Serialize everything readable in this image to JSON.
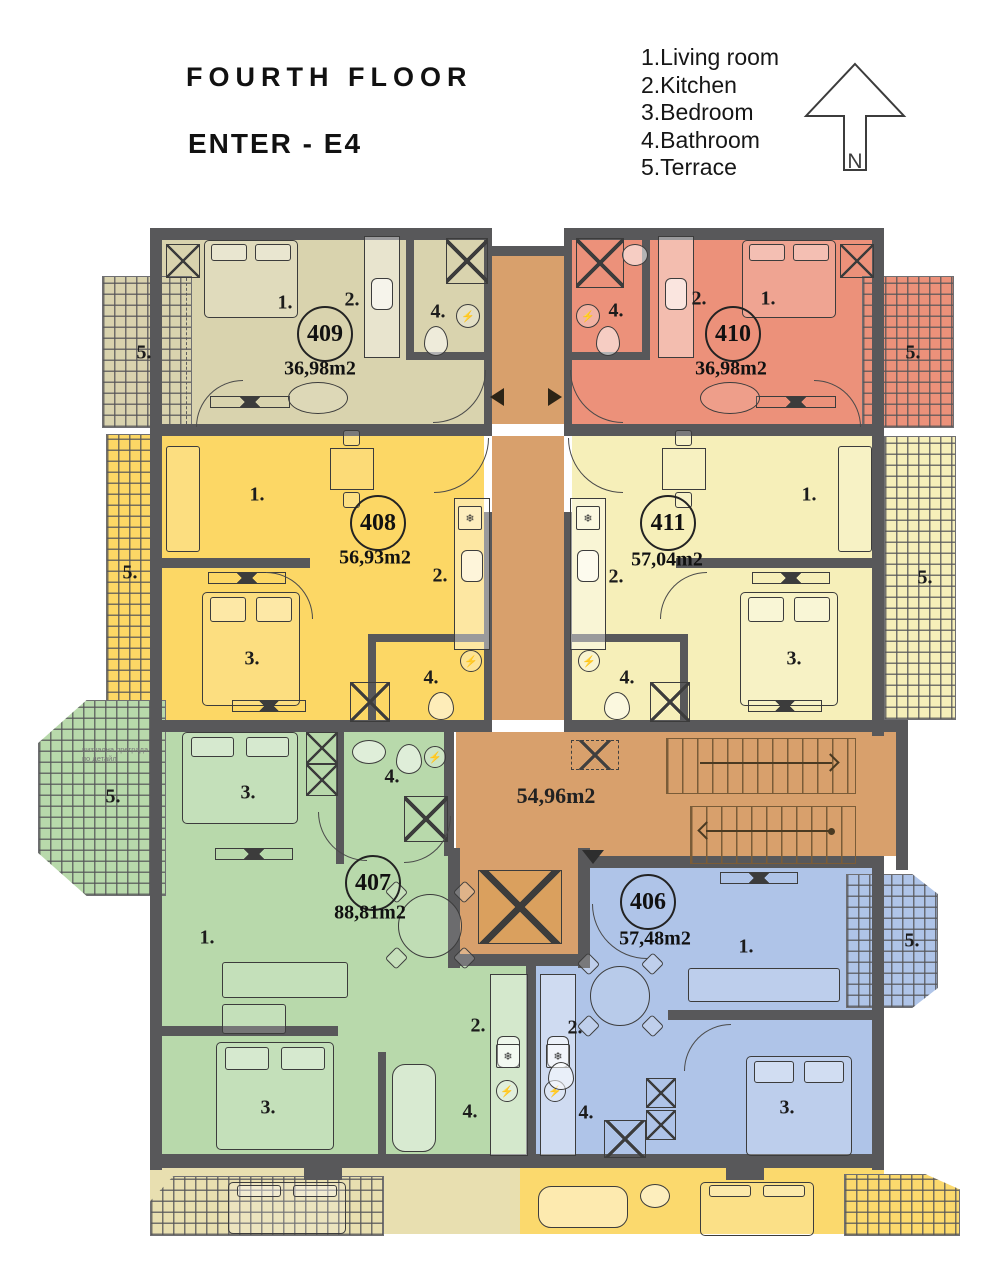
{
  "header": {
    "title": "FOURTH FLOOR",
    "enter": "ENTER - E4"
  },
  "legend": {
    "items": [
      "1.Living room",
      "2.Kitchen",
      "3.Bedroom",
      "4.Bathroom",
      "5.Terrace"
    ]
  },
  "compass": {
    "label": "N"
  },
  "room_labels": {
    "living": "1.",
    "kitchen": "2.",
    "bedroom": "3.",
    "bathroom": "4.",
    "terrace": "5."
  },
  "corridor": {
    "area": "54,96m2",
    "color": "#d8a06c"
  },
  "elevator": {
    "color": "#daa05e"
  },
  "terrace_note": {
    "line1": "визуална преграда",
    "line2": "по детайл"
  },
  "apartments": [
    {
      "number": "409",
      "area": "36,98m2",
      "color": "#d9d3ae"
    },
    {
      "number": "410",
      "area": "36,98m2",
      "color": "#ec917a"
    },
    {
      "number": "408",
      "area": "56,93m2",
      "color": "#fcd765"
    },
    {
      "number": "411",
      "area": "57,04m2",
      "color": "#f6efb9"
    },
    {
      "number": "407",
      "area": "88,81m2",
      "color": "#b8d9ab"
    },
    {
      "number": "406",
      "area": "57,48m2",
      "color": "#afc4e8"
    }
  ],
  "palette": {
    "wall": "#58585a",
    "background": "#ffffff",
    "lower_left": "#e8dfb0",
    "lower_right": "#fbd96d"
  }
}
